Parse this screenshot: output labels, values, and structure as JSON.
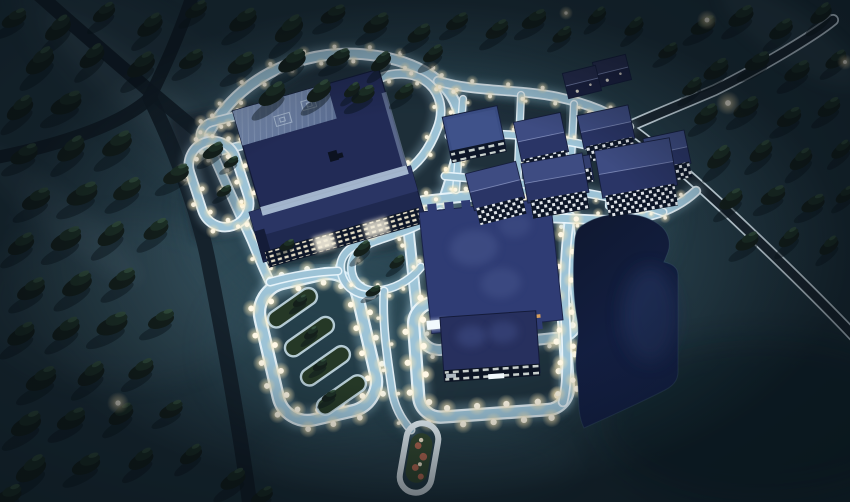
{
  "meta": {
    "view": "aerial-night-campus",
    "description": "Night aerial view of a floodlit campus in a dark conifer forest: large halls and dormitories with lit windows, glowing light-blue walkways lined with streetlights, a dark pond, garden plots, parking loops, dark asphalt roads crossing the forest",
    "time_of_day": "night",
    "width": 850,
    "height": 502
  },
  "colors": {
    "ground_base": "#253b46",
    "ground_dark": "#16272f",
    "ground_fog": "#6e8c9a",
    "campus_glow": "#2e4d5a",
    "zone_dark": "#1c2b35",
    "road_dark": "#131f29",
    "road_surface": "#1d2933",
    "road_edge": "#dcecf5",
    "path_edge": "#eaf6fc",
    "path_fill": "#9dc3d6",
    "path_glow": "#aed6e8",
    "roof_navy_dark": "#222b56",
    "roof_navy": "#2b3768",
    "roof_navy_light": "#3e4c82",
    "roof_flat": "#3a4d84",
    "roof_ridge": "#8a96c4",
    "roof_steel": "#5c6f94",
    "roof_steel_light": "#8296ba",
    "central_roof": "#2f3c74",
    "central_roof_light": "#4a588f",
    "wall_light": "#b9cde0",
    "facade_dark": "#0d1628",
    "window_warm": "#f0e8cf",
    "window_cool": "#eef3f8",
    "window_orange": "#e2a55e",
    "sign_white": "#f2fafe",
    "pond": "#111b34",
    "pond_light": "#20305a",
    "tree_dark": "#141f1b",
    "tree_mid": "#1d3026",
    "tree_light": "#35523f",
    "tree_shadow": "#08131a",
    "light_core": "#fff8e6",
    "plot_green": "#253826",
    "oval_green": "#344a31",
    "plot_red": "#b96a52"
  },
  "scene": {
    "labels": {
      "main_hall": "main-hall",
      "dormitory_long": "long-dormitory",
      "central_hall": "central-hall",
      "lower_hall": "lower-hall",
      "pond": "pond",
      "garden": "garden-plots",
      "parking_loop": "parking-loop",
      "oval_garden": "oval-garden"
    },
    "lights": {
      "main-loop": {
        "s": 16,
        "r": 2.4,
        "o": 0.95
      },
      "west-side": {
        "s": 18,
        "r": 2.4,
        "o": 0.9
      },
      "top-arc": {
        "s": 17,
        "r": 2.4,
        "o": 0.9
      },
      "teardrop": {
        "s": 17,
        "r": 2.3,
        "o": 0.9
      },
      "left-small": {
        "s": 13,
        "r": 2.6,
        "o": 0.95
      },
      "left-big": {
        "s": 14,
        "r": 2.8,
        "o": 0.95
      },
      "central-ring": {
        "s": 19,
        "r": 2.6,
        "o": 0.92
      },
      "garden-ring": {
        "s": 13,
        "r": 3.4,
        "o": 1
      },
      "lower-ring": {
        "s": 15,
        "r": 3.7,
        "o": 1
      },
      "pond-path": {
        "s": 16,
        "r": 3.2,
        "o": 0.95
      },
      "bottom-path": {
        "s": 22,
        "r": 2.2,
        "o": 0.85
      },
      "west-squiggle": {
        "s": 24,
        "r": 2.2,
        "o": 0.85
      },
      "west-down": {
        "s": 26,
        "r": 2.2,
        "o": 0.8
      },
      "dorm-path": {
        "s": 30,
        "r": 1.8,
        "o": 0.75
      }
    },
    "dorms": [
      [
        474,
        132,
        56,
        42,
        -12,
        "flat"
      ],
      [
        495,
        186,
        52,
        38,
        -14,
        "gable"
      ],
      [
        541,
        137,
        48,
        40,
        -12,
        "gable"
      ],
      [
        555,
        178,
        62,
        40,
        -10,
        "gable"
      ],
      [
        577,
        170,
        30,
        26,
        -10,
        "block"
      ],
      [
        606,
        127,
        52,
        34,
        -12,
        "gable"
      ],
      [
        636,
        168,
        76,
        48,
        -10,
        "gable"
      ],
      [
        667,
        151,
        42,
        34,
        -12,
        "gable"
      ],
      [
        582,
        82,
        34,
        26,
        -14,
        "dark"
      ],
      [
        612,
        71,
        34,
        26,
        -14,
        "dark"
      ]
    ],
    "trees": [
      [
        14,
        20,
        1.0
      ],
      [
        58,
        30,
        1.15
      ],
      [
        104,
        14,
        0.95
      ],
      [
        150,
        27,
        1.1
      ],
      [
        196,
        11,
        0.9
      ],
      [
        243,
        22,
        1.15
      ],
      [
        289,
        31,
        1.25
      ],
      [
        333,
        16,
        1.0
      ],
      [
        376,
        25,
        1.05
      ],
      [
        419,
        35,
        0.95
      ],
      [
        457,
        23,
        0.9
      ],
      [
        497,
        31,
        0.95
      ],
      [
        534,
        21,
        1.0
      ],
      [
        562,
        36,
        0.8
      ],
      [
        597,
        17,
        0.8
      ],
      [
        634,
        28,
        0.85
      ],
      [
        40,
        63,
        1.25
      ],
      [
        92,
        58,
        1.1
      ],
      [
        141,
        67,
        1.2
      ],
      [
        191,
        61,
        1.0
      ],
      [
        241,
        65,
        1.1
      ],
      [
        292,
        63,
        1.15
      ],
      [
        338,
        59,
        0.95
      ],
      [
        381,
        63,
        0.9
      ],
      [
        433,
        55,
        0.85
      ],
      [
        272,
        96,
        1.15
      ],
      [
        319,
        93,
        1.05
      ],
      [
        363,
        96,
        0.95
      ],
      [
        404,
        93,
        0.8
      ],
      [
        20,
        110,
        1.15
      ],
      [
        66,
        105,
        1.25
      ],
      [
        24,
        156,
        1.1
      ],
      [
        71,
        151,
        1.2
      ],
      [
        117,
        146,
        1.25
      ],
      [
        36,
        201,
        1.15
      ],
      [
        82,
        196,
        1.25
      ],
      [
        127,
        191,
        1.15
      ],
      [
        21,
        246,
        1.1
      ],
      [
        66,
        241,
        1.25
      ],
      [
        111,
        236,
        1.15
      ],
      [
        156,
        231,
        1.05
      ],
      [
        31,
        291,
        1.15
      ],
      [
        77,
        286,
        1.25
      ],
      [
        122,
        281,
        1.1
      ],
      [
        21,
        336,
        1.15
      ],
      [
        66,
        331,
        1.15
      ],
      [
        112,
        326,
        1.25
      ],
      [
        161,
        321,
        1.05
      ],
      [
        41,
        381,
        1.25
      ],
      [
        91,
        376,
        1.15
      ],
      [
        141,
        371,
        1.05
      ],
      [
        26,
        426,
        1.25
      ],
      [
        71,
        421,
        1.15
      ],
      [
        121,
        416,
        1.05
      ],
      [
        171,
        411,
        0.95
      ],
      [
        31,
        471,
        1.3
      ],
      [
        86,
        466,
        1.15
      ],
      [
        141,
        461,
        1.05
      ],
      [
        191,
        456,
        0.95
      ],
      [
        233,
        481,
        1.05
      ],
      [
        176,
        176,
        1.05
      ],
      [
        213,
        152,
        0.85
      ],
      [
        8,
        497,
        1.1
      ],
      [
        262,
        497,
        0.9
      ],
      [
        362,
        250,
        0.75
      ],
      [
        397,
        263,
        0.65
      ],
      [
        373,
        292,
        0.6
      ],
      [
        300,
        302,
        0.6
      ],
      [
        311,
        334,
        0.6
      ],
      [
        320,
        366,
        0.6
      ],
      [
        329,
        397,
        0.6
      ],
      [
        231,
        163,
        0.6
      ],
      [
        224,
        192,
        0.6
      ],
      [
        352,
        91,
        0.7
      ],
      [
        287,
        246,
        0.6
      ],
      [
        703,
        27,
        1.0
      ],
      [
        741,
        18,
        1.05
      ],
      [
        781,
        31,
        1.0
      ],
      [
        821,
        15,
        0.95
      ],
      [
        716,
        71,
        1.05
      ],
      [
        757,
        63,
        1.0
      ],
      [
        797,
        73,
        1.05
      ],
      [
        836,
        61,
        0.9
      ],
      [
        706,
        116,
        1.0
      ],
      [
        746,
        109,
        1.05
      ],
      [
        789,
        119,
        1.0
      ],
      [
        829,
        109,
        0.95
      ],
      [
        719,
        159,
        1.05
      ],
      [
        761,
        153,
        1.0
      ],
      [
        801,
        161,
        1.0
      ],
      [
        841,
        151,
        0.85
      ],
      [
        731,
        201,
        1.0
      ],
      [
        773,
        197,
        1.0
      ],
      [
        813,
        205,
        0.95
      ],
      [
        747,
        243,
        0.95
      ],
      [
        789,
        239,
        0.9
      ],
      [
        829,
        247,
        0.85
      ],
      [
        845,
        196,
        0.8
      ],
      [
        668,
        52,
        0.8
      ],
      [
        692,
        88,
        0.85
      ]
    ],
    "tree_glows": [
      [
        707,
        20,
        1.0
      ],
      [
        728,
        103,
        1.2
      ],
      [
        118,
        403,
        1.1
      ],
      [
        845,
        62,
        0.8
      ],
      [
        566,
        13,
        0.7
      ]
    ]
  }
}
